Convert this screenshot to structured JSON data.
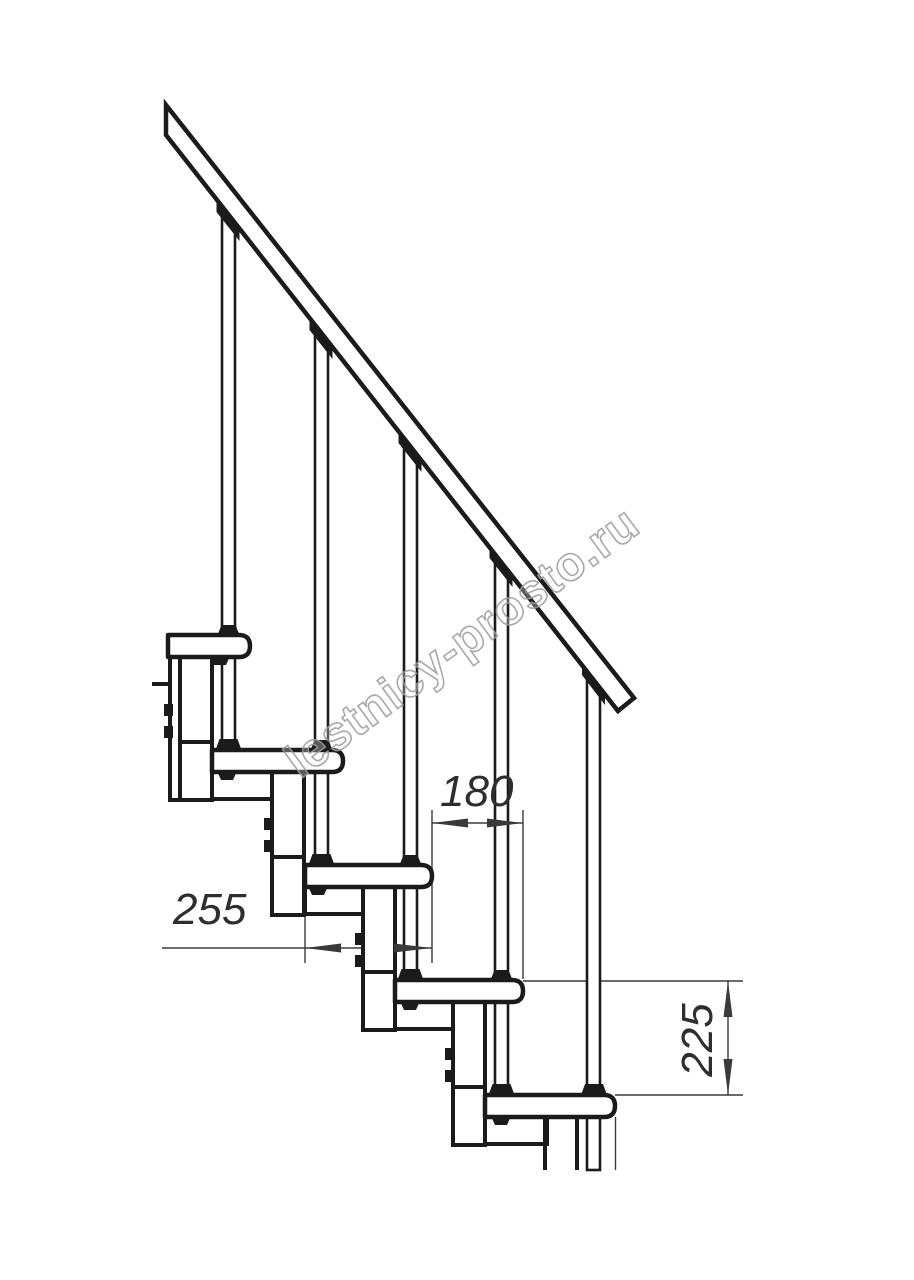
{
  "drawing": {
    "kind_label": "staircase-side-elevation",
    "dimensions": {
      "tread_depth": "255",
      "going": "180",
      "rise": "225"
    },
    "watermark": "lestnicy-prosto.ru",
    "colors": {
      "ink": "#1b1b1b",
      "dim_line": "#3a3a3a",
      "watermark_stroke": "#9a9a9a",
      "background": "#ffffff"
    }
  }
}
